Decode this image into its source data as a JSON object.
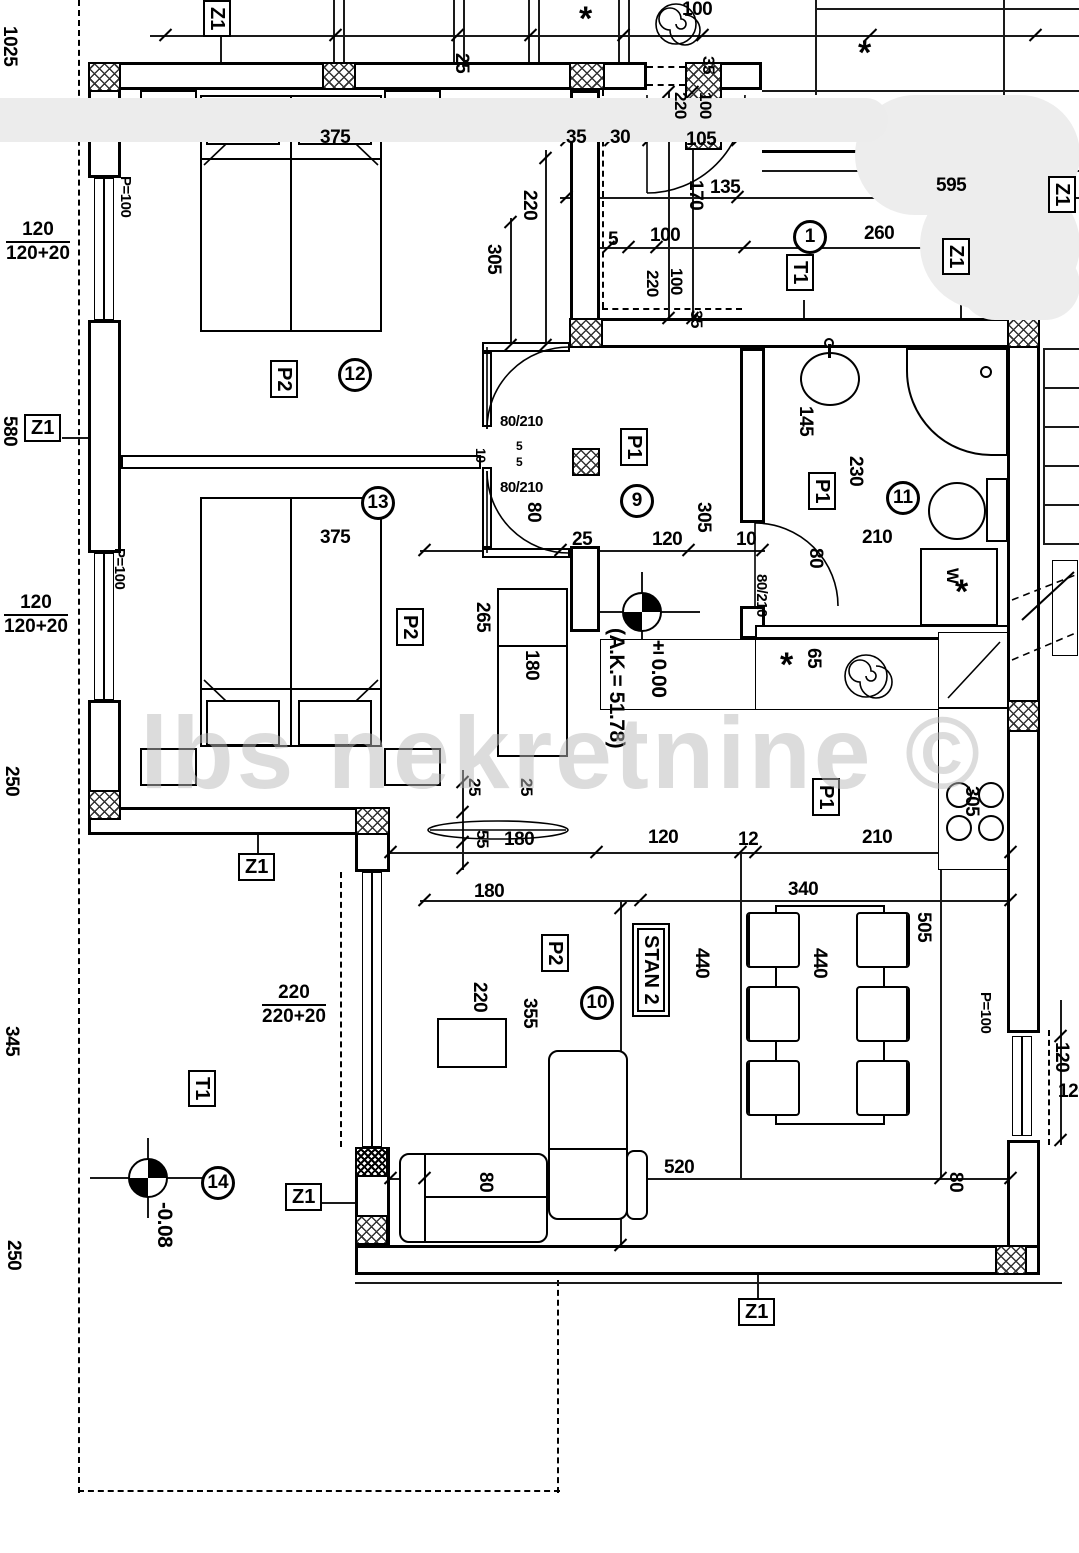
{
  "watermark": {
    "text": "lbs nekretnine ©"
  },
  "unit": {
    "name": "STAN 2"
  },
  "dim_labels": [
    {
      "t": "1025",
      "x": 0,
      "y": 26,
      "o": "v"
    },
    {
      "t": "580",
      "x": 0,
      "y": 416,
      "o": "v"
    },
    {
      "t": "250",
      "x": 2,
      "y": 766,
      "o": "v"
    },
    {
      "t": "345",
      "x": 2,
      "y": 1026,
      "o": "v"
    },
    {
      "t": "250",
      "x": 4,
      "y": 1240,
      "o": "v"
    },
    {
      "t": "P=100",
      "x": 118,
      "y": 176,
      "o": "v",
      "s": 15
    },
    {
      "t": "P=100",
      "x": 112,
      "y": 548,
      "o": "v",
      "s": 15
    },
    {
      "t": "375",
      "x": 320,
      "y": 128,
      "o": "h"
    },
    {
      "t": "375",
      "x": 320,
      "y": 528,
      "o": "h"
    },
    {
      "t": "220",
      "x": 520,
      "y": 190,
      "o": "v"
    },
    {
      "t": "305",
      "x": 484,
      "y": 244,
      "o": "v"
    },
    {
      "t": "25",
      "x": 452,
      "y": 53,
      "o": "v"
    },
    {
      "t": "100",
      "x": 682,
      "y": 0,
      "o": "h"
    },
    {
      "t": "35",
      "x": 566,
      "y": 128,
      "o": "h"
    },
    {
      "t": "30",
      "x": 610,
      "y": 128,
      "o": "h"
    },
    {
      "t": "105",
      "x": 686,
      "y": 130,
      "o": "h"
    },
    {
      "t": "220",
      "x": 672,
      "y": 92,
      "o": "v",
      "s": 17
    },
    {
      "t": "100",
      "x": 697,
      "y": 92,
      "o": "v",
      "s": 17
    },
    {
      "t": "35",
      "x": 700,
      "y": 56,
      "o": "v",
      "s": 17
    },
    {
      "t": "135",
      "x": 710,
      "y": 178,
      "o": "h"
    },
    {
      "t": "170",
      "x": 686,
      "y": 180,
      "o": "v"
    },
    {
      "t": "595",
      "x": 936,
      "y": 176,
      "o": "h"
    },
    {
      "t": "5",
      "x": 608,
      "y": 230,
      "o": "h"
    },
    {
      "t": "100",
      "x": 650,
      "y": 226,
      "o": "h"
    },
    {
      "t": "260",
      "x": 864,
      "y": 224,
      "o": "h"
    },
    {
      "t": "220",
      "x": 644,
      "y": 270,
      "o": "v",
      "s": 17
    },
    {
      "t": "100",
      "x": 668,
      "y": 268,
      "o": "v",
      "s": 17
    },
    {
      "t": "35",
      "x": 688,
      "y": 310,
      "o": "v",
      "s": 17
    },
    {
      "t": "80/210",
      "x": 500,
      "y": 414,
      "o": "h",
      "s": 15
    },
    {
      "t": "5",
      "x": 516,
      "y": 440,
      "o": "h",
      "s": 12
    },
    {
      "t": "5",
      "x": 516,
      "y": 456,
      "o": "h",
      "s": 12
    },
    {
      "t": "10",
      "x": 474,
      "y": 448,
      "o": "v",
      "s": 14
    },
    {
      "t": "80/210",
      "x": 500,
      "y": 480,
      "o": "h",
      "s": 15
    },
    {
      "t": "80",
      "x": 524,
      "y": 502,
      "o": "v"
    },
    {
      "t": "25",
      "x": 572,
      "y": 530,
      "o": "h"
    },
    {
      "t": "120",
      "x": 652,
      "y": 530,
      "o": "h"
    },
    {
      "t": "10",
      "x": 736,
      "y": 530,
      "o": "h"
    },
    {
      "t": "305",
      "x": 694,
      "y": 502,
      "o": "v"
    },
    {
      "t": "145",
      "x": 796,
      "y": 406,
      "o": "v"
    },
    {
      "t": "230",
      "x": 846,
      "y": 456,
      "o": "v"
    },
    {
      "t": "210",
      "x": 862,
      "y": 528,
      "o": "h"
    },
    {
      "t": "80",
      "x": 806,
      "y": 548,
      "o": "v"
    },
    {
      "t": "80/210",
      "x": 754,
      "y": 574,
      "o": "v",
      "s": 15
    },
    {
      "t": "65",
      "x": 804,
      "y": 648,
      "o": "v"
    },
    {
      "t": "305",
      "x": 962,
      "y": 786,
      "o": "v"
    },
    {
      "t": "265",
      "x": 473,
      "y": 602,
      "o": "v"
    },
    {
      "t": "180",
      "x": 522,
      "y": 650,
      "o": "v"
    },
    {
      "t": "25",
      "x": 466,
      "y": 778,
      "o": "v",
      "s": 17
    },
    {
      "t": "25",
      "x": 518,
      "y": 778,
      "o": "v",
      "s": 17
    },
    {
      "t": "55",
      "x": 474,
      "y": 830,
      "o": "v",
      "s": 17
    },
    {
      "t": "180",
      "x": 504,
      "y": 830,
      "o": "h"
    },
    {
      "t": "180",
      "x": 474,
      "y": 882,
      "o": "h"
    },
    {
      "t": "120",
      "x": 648,
      "y": 828,
      "o": "h"
    },
    {
      "t": "12",
      "x": 738,
      "y": 830,
      "o": "h"
    },
    {
      "t": "210",
      "x": 862,
      "y": 828,
      "o": "h"
    },
    {
      "t": "340",
      "x": 788,
      "y": 880,
      "o": "h"
    },
    {
      "t": "440",
      "x": 692,
      "y": 948,
      "o": "v"
    },
    {
      "t": "440",
      "x": 810,
      "y": 948,
      "o": "v"
    },
    {
      "t": "505",
      "x": 914,
      "y": 912,
      "o": "v"
    },
    {
      "t": "220",
      "x": 470,
      "y": 982,
      "o": "v"
    },
    {
      "t": "355",
      "x": 520,
      "y": 998,
      "o": "v"
    },
    {
      "t": "520",
      "x": 664,
      "y": 1158,
      "o": "h"
    },
    {
      "t": "80",
      "x": 476,
      "y": 1172,
      "o": "v"
    },
    {
      "t": "80",
      "x": 946,
      "y": 1172,
      "o": "v"
    },
    {
      "t": "P=100",
      "x": 978,
      "y": 992,
      "o": "v",
      "s": 15
    },
    {
      "t": "120",
      "x": 1052,
      "y": 1042,
      "o": "v"
    },
    {
      "t": "120",
      "x": 1058,
      "y": 1082,
      "o": "h"
    },
    {
      "t": "W",
      "x": 944,
      "y": 568,
      "o": "v",
      "s": 17
    }
  ],
  "fractions": [
    {
      "top": "120",
      "bottom": "120+20",
      "x": 6,
      "y": 220
    },
    {
      "top": "120",
      "bottom": "120+20",
      "x": 4,
      "y": 593
    },
    {
      "top": "220",
      "bottom": "220+20",
      "x": 262,
      "y": 983
    }
  ],
  "ref_boxes": [
    {
      "t": "Z1",
      "x": 203,
      "y": 0,
      "o": "v"
    },
    {
      "t": "Z1",
      "x": 24,
      "y": 414,
      "o": "h"
    },
    {
      "t": "Z1",
      "x": 238,
      "y": 853,
      "o": "h"
    },
    {
      "t": "Z1",
      "x": 285,
      "y": 1183,
      "o": "h"
    },
    {
      "t": "Z1",
      "x": 738,
      "y": 1298,
      "o": "h"
    },
    {
      "t": "Z1",
      "x": 942,
      "y": 238,
      "o": "v"
    },
    {
      "t": "Z1",
      "x": 1048,
      "y": 176,
      "o": "v"
    },
    {
      "t": "T1",
      "x": 188,
      "y": 1070,
      "o": "v"
    },
    {
      "t": "T1",
      "x": 786,
      "y": 254,
      "o": "v"
    },
    {
      "t": "P2",
      "x": 270,
      "y": 360,
      "o": "v"
    },
    {
      "t": "P2",
      "x": 396,
      "y": 608,
      "o": "v"
    },
    {
      "t": "P2",
      "x": 541,
      "y": 934,
      "o": "v"
    },
    {
      "t": "P1",
      "x": 620,
      "y": 428,
      "o": "v"
    },
    {
      "t": "P1",
      "x": 808,
      "y": 472,
      "o": "v"
    },
    {
      "t": "P1",
      "x": 812,
      "y": 778,
      "o": "v"
    },
    {
      "t": "STAN 2",
      "x": 637,
      "y": 928,
      "o": "v",
      "double": 1
    }
  ],
  "circled_numbers": [
    {
      "t": "12",
      "x": 338,
      "y": 358
    },
    {
      "t": "13",
      "x": 361,
      "y": 486
    },
    {
      "t": "9",
      "x": 620,
      "y": 484
    },
    {
      "t": "11",
      "x": 886,
      "y": 481
    },
    {
      "t": "1",
      "x": 793,
      "y": 220
    },
    {
      "t": "10",
      "x": 580,
      "y": 986
    },
    {
      "t": "14",
      "x": 201,
      "y": 1166
    }
  ],
  "elevation_markers": [
    {
      "label": "±0.00",
      "note": "(A.K.= 51.78)",
      "x": 622,
      "y": 592
    },
    {
      "label": "-0.08",
      "note": "",
      "x": 128,
      "y": 1158
    }
  ],
  "symbols": [
    {
      "t": "*",
      "x": 579,
      "y": 14
    },
    {
      "t": "*",
      "x": 858,
      "y": 48
    },
    {
      "t": "*",
      "x": 780,
      "y": 660
    },
    {
      "t": "*",
      "x": 955,
      "y": 587
    }
  ]
}
